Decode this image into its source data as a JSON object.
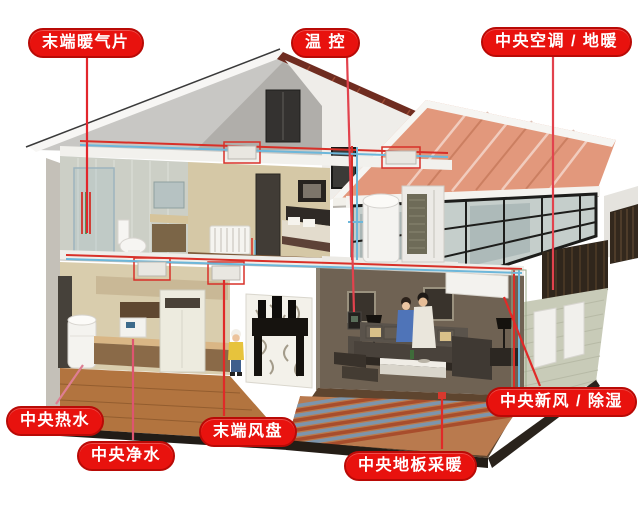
{
  "figure": {
    "type": "annotated cutaway house HVAC diagram",
    "background": "#ffffff"
  },
  "labels": [
    {
      "id": "terminal-radiator",
      "text": "末端暖气片"
    },
    {
      "id": "thermostat",
      "text": "温 控"
    },
    {
      "id": "central-ac-floor-heating",
      "text": "中央空调 / 地暖"
    },
    {
      "id": "central-hot-water",
      "text": "中央热水"
    },
    {
      "id": "central-water-purifier",
      "text": "中央净水"
    },
    {
      "id": "terminal-fan-coil",
      "text": "末端风盘"
    },
    {
      "id": "central-floor-heating",
      "text": "中央地板采暖"
    },
    {
      "id": "central-fresh-air-dehumidification",
      "text": "中央新风 / 除湿"
    }
  ],
  "icons": [
    {
      "name": "house-cutaway-illustration"
    },
    {
      "name": "heat-pump-outdoor-unit"
    },
    {
      "name": "water-tank"
    },
    {
      "name": "radiator"
    },
    {
      "name": "fan-coil-unit"
    },
    {
      "name": "floor-heating-coils"
    }
  ],
  "colors": {
    "label_background": "#e8120e",
    "label_border": "#b90a06",
    "label_text": "#ffffff",
    "leader_line_red": "#e02a2c",
    "leader_line_pink": "#de5f78",
    "pipe_hot": "#d83028",
    "pipe_cold": "#6db7da",
    "roof_tiles": "#e2987c",
    "roof_underside": "#c8c7c4",
    "brick_wall": "#c8cbb8",
    "wood_floor": "#b2743f",
    "floor_heating_stripe_warm": "#a84d2c",
    "floor_heating_stripe_cool": "#7d95ac"
  }
}
